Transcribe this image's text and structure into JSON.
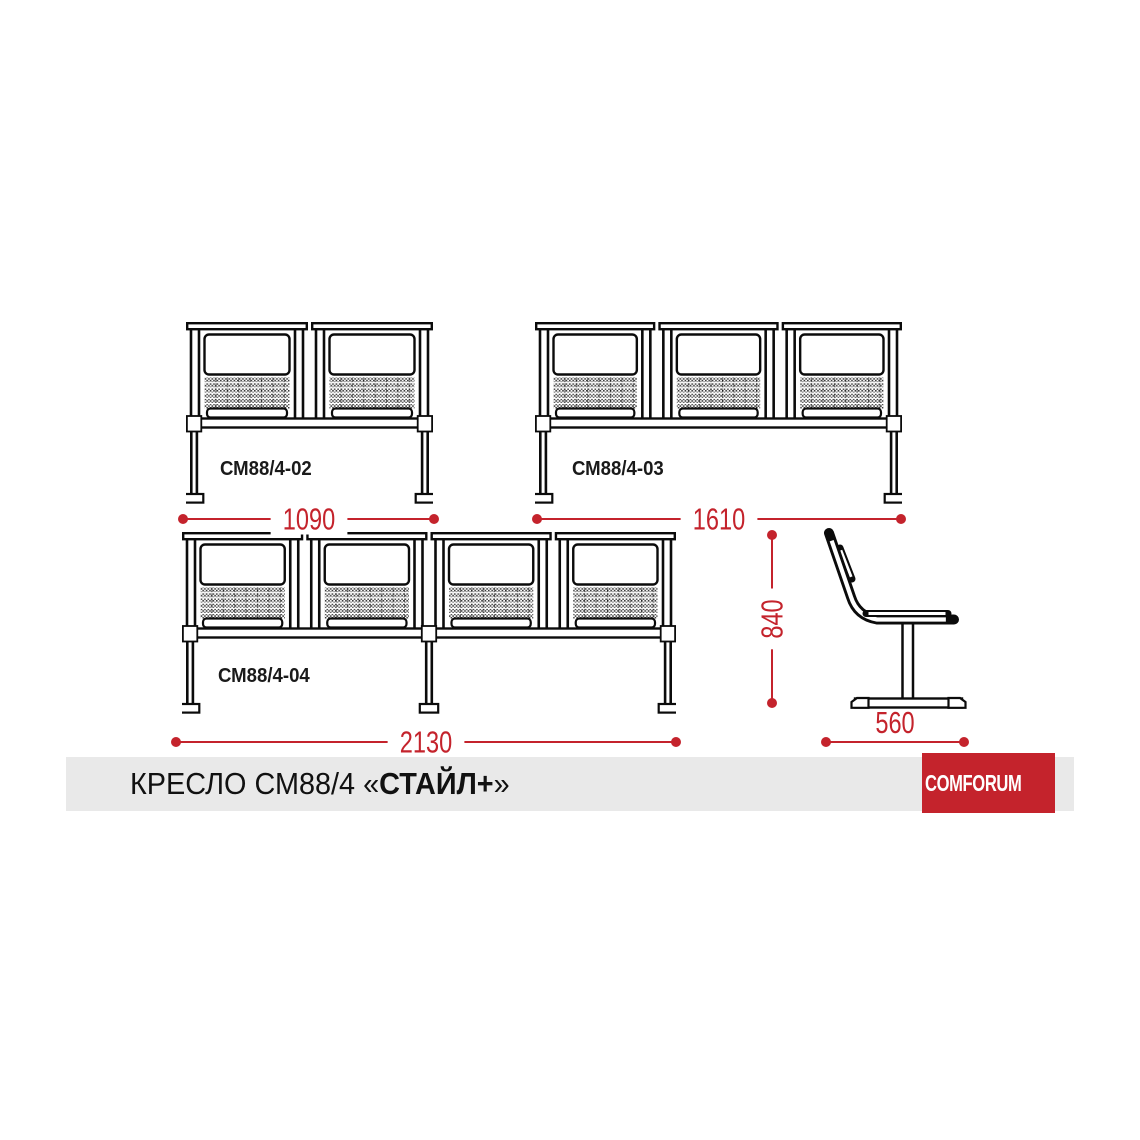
{
  "title": {
    "regular_part": "КРЕСЛО СМ88/4 «",
    "bold_part": "СТАЙЛ+",
    "closing_quote": "»"
  },
  "brand": {
    "name": "COMFORUM",
    "icon": "awning-arch-icon"
  },
  "benches": [
    {
      "model": "СМ88/4-02",
      "seats": 2,
      "width_mm": "1090"
    },
    {
      "model": "СМ88/4-03",
      "seats": 3,
      "width_mm": "1610"
    },
    {
      "model": "СМ88/4-04",
      "seats": 4,
      "width_mm": "2130"
    }
  ],
  "side_view": {
    "height_mm": "840",
    "depth_mm": "560"
  },
  "colors": {
    "accent": "#c4232c",
    "line": "#0b0b0b",
    "footer_bg": "#e9e9e9",
    "logo_bg": "#c4232c"
  }
}
